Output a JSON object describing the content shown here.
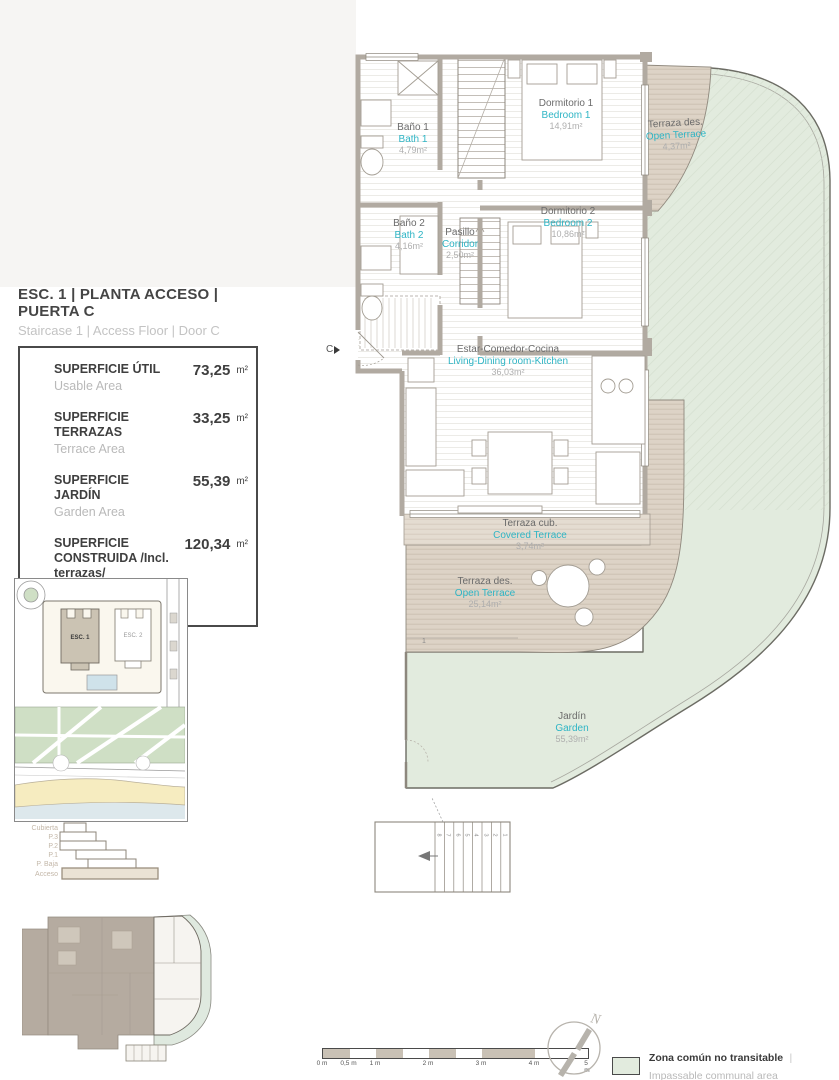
{
  "header": {
    "title_es": "ESC. 1 | PLANTA ACCESO | PUERTA C",
    "title_en": "Staircase 1 | Access Floor | Door C"
  },
  "areas_table": {
    "rows": [
      {
        "label_es": "SUPERFICIE ÚTIL",
        "label_en": "Usable Area",
        "value": "73,25",
        "unit": "m²"
      },
      {
        "label_es": "SUPERFICIE TERRAZAS",
        "label_en": "Terrace Area",
        "value": "33,25",
        "unit": "m²"
      },
      {
        "label_es": "SUPERFICIE JARDÍN",
        "label_en": "Garden Area",
        "value": "55,39",
        "unit": "m²"
      },
      {
        "label_es": "SUPERFICIE CONSTRUIDA /Incl. terrazas/",
        "label_en": "Built Area /Incl. terrace/",
        "value": "120,34",
        "unit": "m²"
      }
    ]
  },
  "site_map": {
    "building_1": "ESC. 1",
    "building_2": "ESC. 2"
  },
  "section": {
    "levels": [
      "Cubierta",
      "P.3",
      "P.2",
      "P.1",
      "P. Baja",
      "Acceso"
    ]
  },
  "plan": {
    "entrance_label": "C",
    "terrace_step_label": "1",
    "rooms": [
      {
        "name_es": "Baño 1",
        "name_en": "Bath 1",
        "area": "4,79m²"
      },
      {
        "name_es": "Dormitorio 1",
        "name_en": "Bedroom 1",
        "area": "14,91m²"
      },
      {
        "name_es": "Terraza des.",
        "name_en": "Open Terrace",
        "area": "4,37m²"
      },
      {
        "name_es": "Baño 2",
        "name_en": "Bath 2",
        "area": "4,16m²"
      },
      {
        "name_es": "Pasillo",
        "name_en": "Corridor",
        "area": "2,50m²"
      },
      {
        "name_es": "Dormitorio 2",
        "name_en": "Bedroom 2",
        "area": "10,86m²"
      },
      {
        "name_es": "Estar-Comedor-Cocina",
        "name_en": "Living-Dining room-Kitchen",
        "area": "36,03m²"
      },
      {
        "name_es": "Terraza cub.",
        "name_en": "Covered Terrace",
        "area": "3,74m²"
      },
      {
        "name_es": "Terraza des.",
        "name_en": "Open Terrace",
        "area": "25,14m²"
      },
      {
        "name_es": "Jardín",
        "name_en": "Garden",
        "area": "55,39m²"
      }
    ],
    "stair_numbers": [
      "8",
      "7",
      "6",
      "5",
      "4",
      "3",
      "2",
      "1"
    ]
  },
  "scale_bar": {
    "labels": [
      "0 m",
      "0,5 m",
      "1 m",
      "2 m",
      "3 m",
      "4 m",
      "5 m"
    ]
  },
  "compass": {
    "north_label": "N"
  },
  "legend": {
    "label_es": "Zona común no transitable",
    "separator": "|",
    "label_en": "Impassable communal area",
    "swatch_color": "#e2ebde"
  },
  "colors": {
    "accent_cyan": "#2fb5c5",
    "garden_green": "#e2ebde",
    "deck_beige": "#ddd3c6",
    "wall_gray": "#b1aaa1"
  }
}
